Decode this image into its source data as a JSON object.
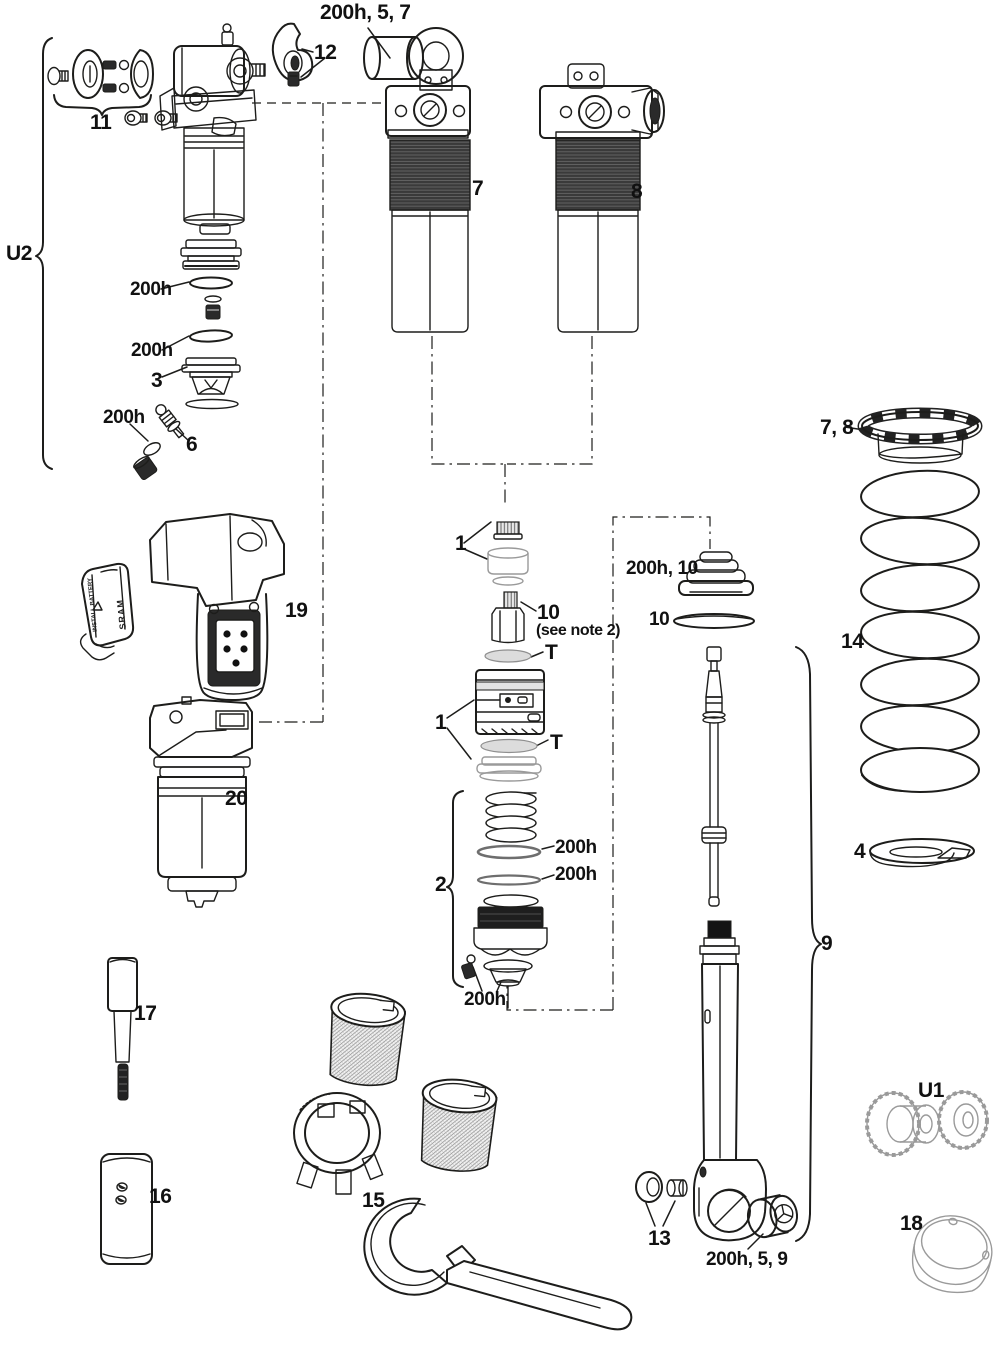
{
  "figure": {
    "type": "exploded-parts-diagram",
    "background": "#ffffff",
    "line_color": "#1d1d1b",
    "thread_fill": "#3a3a3a",
    "accent_gray": "#9a9a9a"
  },
  "labels": {
    "u2_group": "U2",
    "group_11": "11",
    "part_12": "12",
    "bumper_group": "200h, 5, 7",
    "shock_body_7": "7",
    "shock_body_8": "8",
    "oring_a": "200h",
    "oring_b": "200h",
    "valve_cap_3": "3",
    "oring_c": "200h",
    "valve_core_6": "6",
    "module_19": "19",
    "reservoir_20": "20",
    "topcap_1a": "1",
    "adjuster_10": "10",
    "adjuster_note": "(see note 2)",
    "t_upper": "T",
    "canister_1b": "1",
    "t_lower": "T",
    "piston_group_2": "2",
    "oring_d": "200h",
    "oring_e": "200h",
    "oring_f": "200h",
    "bellows_group": "200h, 10",
    "washer_10": "10",
    "preload_ring_78": "7, 8",
    "coil_spring_14": "14",
    "spring_retainer_4": "4",
    "damper_group_9": "9",
    "tool_17": "17",
    "tool_16": "16",
    "tool_set_15": "15",
    "nut_13": "13",
    "bushing_group": "200h, 5, 9",
    "mount_u1": "U1",
    "cap_18": "18",
    "battery_warning": "INSTALL BATTERY",
    "battery_brand": "SRAM"
  }
}
